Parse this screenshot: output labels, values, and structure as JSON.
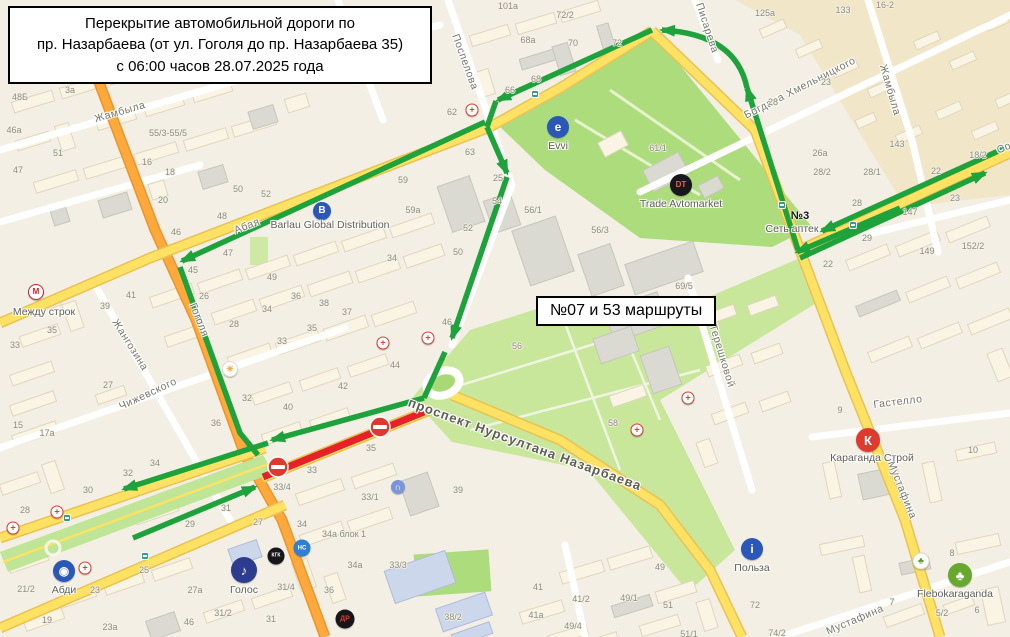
{
  "title_box": {
    "text": "Перекрытие автомобильной дороги по\nпр. Назарбаева (от ул. Гоголя до пр. Назарбаева 35)\nс 06:00 часов 28.07.2025 года"
  },
  "route_box": {
    "text": "№07 и 53 маршруты"
  },
  "colors": {
    "detour_green": "#1ea33c",
    "closed_red": "#e62129",
    "no_entry_red": "#e0372e",
    "road_yellow": "#ffe163",
    "road_orange": "#ffa93c",
    "park_green": "#addc7c",
    "background": "#f3efe4"
  },
  "map": {
    "street_labels": [
      {
        "text": "Жамбыла",
        "x": 120,
        "y": 112,
        "rot": -16
      },
      {
        "text": "Абая",
        "x": 247,
        "y": 226,
        "rot": -21
      },
      {
        "text": "Поспелова",
        "x": 465,
        "y": 62,
        "rot": 70
      },
      {
        "text": "Гоголя",
        "x": 199,
        "y": 320,
        "rot": 68
      },
      {
        "text": "Жангозина",
        "x": 130,
        "y": 345,
        "rot": 58
      },
      {
        "text": "Чижевского",
        "x": 148,
        "y": 394,
        "rot": -25
      },
      {
        "text": "Богдана Хмельницкого",
        "x": 800,
        "y": 88,
        "rot": -27
      },
      {
        "text": "Писарева",
        "x": 707,
        "y": 28,
        "rot": 72
      },
      {
        "text": "Жамбыла",
        "x": 890,
        "y": 90,
        "rot": 74
      },
      {
        "text": "Терешковой",
        "x": 722,
        "y": 356,
        "rot": 73
      },
      {
        "text": "Гастелло",
        "x": 898,
        "y": 402,
        "rot": -7
      },
      {
        "text": "Мустафина",
        "x": 902,
        "y": 490,
        "rot": 68
      },
      {
        "text": "Мустафина",
        "x": 855,
        "y": 620,
        "rot": -23
      },
      {
        "text": "Со",
        "x": 1004,
        "y": 148,
        "rot": -23
      },
      {
        "text": "проспект Нурсултана Назарбаева",
        "x": 525,
        "y": 444,
        "rot": 20,
        "avenue": true
      }
    ],
    "house_numbers": [
      {
        "t": "48Б",
        "x": 20,
        "y": 97
      },
      {
        "t": "46а",
        "x": 14,
        "y": 130
      },
      {
        "t": "3а",
        "x": 70,
        "y": 90
      },
      {
        "t": "51",
        "x": 58,
        "y": 153
      },
      {
        "t": "47",
        "x": 18,
        "y": 170
      },
      {
        "t": "55/3-55/5",
        "x": 168,
        "y": 133
      },
      {
        "t": "16",
        "x": 147,
        "y": 162
      },
      {
        "t": "18",
        "x": 170,
        "y": 172
      },
      {
        "t": "20",
        "x": 163,
        "y": 200
      },
      {
        "t": "50",
        "x": 238,
        "y": 189
      },
      {
        "t": "48",
        "x": 222,
        "y": 216
      },
      {
        "t": "52",
        "x": 266,
        "y": 194
      },
      {
        "t": "46",
        "x": 176,
        "y": 232
      },
      {
        "t": "47",
        "x": 228,
        "y": 253
      },
      {
        "t": "45",
        "x": 193,
        "y": 270
      },
      {
        "t": "49",
        "x": 272,
        "y": 277
      },
      {
        "t": "26",
        "x": 204,
        "y": 296
      },
      {
        "t": "34",
        "x": 267,
        "y": 309
      },
      {
        "t": "36",
        "x": 296,
        "y": 296
      },
      {
        "t": "38",
        "x": 324,
        "y": 303
      },
      {
        "t": "37",
        "x": 347,
        "y": 312
      },
      {
        "t": "35",
        "x": 312,
        "y": 328
      },
      {
        "t": "33",
        "x": 282,
        "y": 341
      },
      {
        "t": "28",
        "x": 234,
        "y": 324
      },
      {
        "t": "27",
        "x": 108,
        "y": 385
      },
      {
        "t": "42",
        "x": 343,
        "y": 386
      },
      {
        "t": "32",
        "x": 247,
        "y": 398
      },
      {
        "t": "40",
        "x": 288,
        "y": 407
      },
      {
        "t": "36",
        "x": 216,
        "y": 423
      },
      {
        "t": "41",
        "x": 131,
        "y": 295
      },
      {
        "t": "39",
        "x": 105,
        "y": 306
      },
      {
        "t": "59а",
        "x": 413,
        "y": 210
      },
      {
        "t": "63",
        "x": 470,
        "y": 152
      },
      {
        "t": "59",
        "x": 403,
        "y": 180
      },
      {
        "t": "25",
        "x": 498,
        "y": 178
      },
      {
        "t": "54",
        "x": 497,
        "y": 201
      },
      {
        "t": "52",
        "x": 468,
        "y": 228
      },
      {
        "t": "50",
        "x": 458,
        "y": 252
      },
      {
        "t": "56/1",
        "x": 533,
        "y": 210
      },
      {
        "t": "34",
        "x": 392,
        "y": 258
      },
      {
        "t": "101а",
        "x": 508,
        "y": 6
      },
      {
        "t": "72/2",
        "x": 565,
        "y": 15
      },
      {
        "t": "68а",
        "x": 528,
        "y": 40
      },
      {
        "t": "70",
        "x": 573,
        "y": 43
      },
      {
        "t": "72",
        "x": 617,
        "y": 43
      },
      {
        "t": "68",
        "x": 536,
        "y": 79
      },
      {
        "t": "66",
        "x": 510,
        "y": 90
      },
      {
        "t": "62",
        "x": 452,
        "y": 112
      },
      {
        "t": "125а",
        "x": 765,
        "y": 13
      },
      {
        "t": "133",
        "x": 843,
        "y": 10
      },
      {
        "t": "16-2",
        "x": 885,
        "y": 5
      },
      {
        "t": "23",
        "x": 826,
        "y": 82
      },
      {
        "t": "28",
        "x": 773,
        "y": 102
      },
      {
        "t": "26а",
        "x": 820,
        "y": 153
      },
      {
        "t": "143",
        "x": 897,
        "y": 144
      },
      {
        "t": "28/2",
        "x": 822,
        "y": 172
      },
      {
        "t": "28/1",
        "x": 872,
        "y": 172
      },
      {
        "t": "22",
        "x": 936,
        "y": 171
      },
      {
        "t": "18/2",
        "x": 978,
        "y": 155
      },
      {
        "t": "23",
        "x": 955,
        "y": 198
      },
      {
        "t": "28",
        "x": 857,
        "y": 203
      },
      {
        "t": "147",
        "x": 910,
        "y": 212
      },
      {
        "t": "29",
        "x": 867,
        "y": 238
      },
      {
        "t": "149",
        "x": 927,
        "y": 251
      },
      {
        "t": "152/2",
        "x": 973,
        "y": 246
      },
      {
        "t": "22",
        "x": 828,
        "y": 264
      },
      {
        "t": "9",
        "x": 840,
        "y": 410
      },
      {
        "t": "10",
        "x": 973,
        "y": 450
      },
      {
        "t": "72",
        "x": 755,
        "y": 605
      },
      {
        "t": "74/2",
        "x": 777,
        "y": 633
      },
      {
        "t": "7",
        "x": 892,
        "y": 602
      },
      {
        "t": "8",
        "x": 952,
        "y": 553
      },
      {
        "t": "6",
        "x": 977,
        "y": 610
      },
      {
        "t": "5/2",
        "x": 942,
        "y": 613
      },
      {
        "t": "29",
        "x": 190,
        "y": 524
      },
      {
        "t": "27",
        "x": 258,
        "y": 522
      },
      {
        "t": "34",
        "x": 302,
        "y": 524
      },
      {
        "t": "25",
        "x": 144,
        "y": 570
      },
      {
        "t": "27а",
        "x": 195,
        "y": 590
      },
      {
        "t": "21/2",
        "x": 26,
        "y": 589
      },
      {
        "t": "23",
        "x": 95,
        "y": 590
      },
      {
        "t": "19",
        "x": 47,
        "y": 620
      },
      {
        "t": "23а",
        "x": 110,
        "y": 627
      },
      {
        "t": "46",
        "x": 189,
        "y": 622
      },
      {
        "t": "31/2",
        "x": 223,
        "y": 613
      },
      {
        "t": "31",
        "x": 271,
        "y": 619
      },
      {
        "t": "31/4",
        "x": 286,
        "y": 587
      },
      {
        "t": "34а блок 1",
        "x": 344,
        "y": 534
      },
      {
        "t": "34а",
        "x": 355,
        "y": 565
      },
      {
        "t": "36",
        "x": 329,
        "y": 590
      },
      {
        "t": "33/3",
        "x": 398,
        "y": 565
      },
      {
        "t": "38/2",
        "x": 453,
        "y": 617
      },
      {
        "t": "41",
        "x": 538,
        "y": 587
      },
      {
        "t": "41/2",
        "x": 581,
        "y": 599
      },
      {
        "t": "41а",
        "x": 536,
        "y": 615
      },
      {
        "t": "49/4",
        "x": 573,
        "y": 626
      },
      {
        "t": "49/1",
        "x": 629,
        "y": 598
      },
      {
        "t": "49",
        "x": 660,
        "y": 567
      },
      {
        "t": "51",
        "x": 668,
        "y": 605
      },
      {
        "t": "51/1",
        "x": 689,
        "y": 634
      },
      {
        "t": "35",
        "x": 371,
        "y": 448
      },
      {
        "t": "33",
        "x": 312,
        "y": 470
      },
      {
        "t": "33/4",
        "x": 282,
        "y": 487
      },
      {
        "t": "33/1",
        "x": 370,
        "y": 497
      },
      {
        "t": "39",
        "x": 458,
        "y": 490
      },
      {
        "t": "58",
        "x": 613,
        "y": 423
      },
      {
        "t": "56",
        "x": 517,
        "y": 346
      },
      {
        "t": "44",
        "x": 395,
        "y": 365
      },
      {
        "t": "46",
        "x": 447,
        "y": 322
      },
      {
        "t": "33",
        "x": 15,
        "y": 345
      },
      {
        "t": "35",
        "x": 52,
        "y": 330
      },
      {
        "t": "15",
        "x": 18,
        "y": 425
      },
      {
        "t": "17а",
        "x": 47,
        "y": 433
      },
      {
        "t": "34",
        "x": 155,
        "y": 463
      },
      {
        "t": "32",
        "x": 128,
        "y": 473
      },
      {
        "t": "30",
        "x": 88,
        "y": 490
      },
      {
        "t": "28",
        "x": 25,
        "y": 510
      },
      {
        "t": "31",
        "x": 226,
        "y": 508
      },
      {
        "t": "69/5",
        "x": 684,
        "y": 286
      },
      {
        "t": "56/3",
        "x": 600,
        "y": 230
      },
      {
        "t": "61/1",
        "x": 658,
        "y": 148
      }
    ],
    "pois": [
      {
        "id": "evvi",
        "glyph": "e",
        "bg": "#2b58b8",
        "fg": "#fff",
        "x": 558,
        "y": 127,
        "d": 22,
        "label": "Evvi",
        "lx": 558,
        "ly": 140
      },
      {
        "id": "trade-avtomarket",
        "glyph": "DT",
        "bg": "#18181c",
        "fg": "#ff5a36",
        "x": 681,
        "y": 185,
        "d": 22,
        "gs": 8,
        "label": "Trade Avtomarket",
        "lx": 681,
        "ly": 198
      },
      {
        "id": "barlau",
        "glyph": "В",
        "bg": "#2b58b8",
        "fg": "#fff",
        "x": 322,
        "y": 211,
        "d": 18,
        "label": "Barlau Global Distribution",
        "lx": 330,
        "ly": 219
      },
      {
        "id": "mezhdu-strok",
        "glyph": "М",
        "bg": "#ffffff",
        "fg": "#d21f26",
        "x": 36,
        "y": 292,
        "d": 14,
        "border": "#d21f26",
        "label": "Между строк",
        "lx": 44,
        "ly": 306
      },
      {
        "id": "karaganda-stroy",
        "glyph": "К",
        "bg": "#e0392e",
        "fg": "#fff",
        "x": 868,
        "y": 440,
        "d": 24,
        "label": "Караганда Строй",
        "lx": 872,
        "ly": 452
      },
      {
        "id": "polza",
        "glyph": "i",
        "bg": "#2b58b8",
        "fg": "#fff",
        "x": 752,
        "y": 549,
        "d": 22,
        "label": "Польза",
        "lx": 752,
        "ly": 562
      },
      {
        "id": "flebokaraganda",
        "glyph": "♣",
        "bg": "#69a82f",
        "fg": "#fff",
        "x": 960,
        "y": 575,
        "d": 24,
        "label": "Flebokaraganda",
        "lx": 955,
        "ly": 588
      },
      {
        "id": "abdi",
        "glyph": "◉",
        "bg": "#2b58b8",
        "fg": "#fff",
        "x": 64,
        "y": 571,
        "d": 22,
        "label": "Абди",
        "lx": 64,
        "ly": 584
      },
      {
        "id": "golos",
        "glyph": "♪",
        "bg": "#2d3c8e",
        "fg": "#fff",
        "x": 244,
        "y": 570,
        "d": 26,
        "gs": 13,
        "label": "Голос",
        "lx": 244,
        "ly": 584
      },
      {
        "id": "kgk",
        "glyph": "КГК",
        "bg": "#17171a",
        "fg": "#fff",
        "x": 276,
        "y": 556,
        "d": 17,
        "gs": 5
      },
      {
        "id": "ns",
        "glyph": "НС",
        "bg": "#2f80d0",
        "fg": "#fff",
        "x": 302,
        "y": 548,
        "d": 17,
        "gs": 6
      },
      {
        "id": "dom-rida",
        "glyph": "ДР",
        "bg": "#17171a",
        "fg": "#e0392e",
        "x": 345,
        "y": 619,
        "d": 19,
        "gs": 7
      },
      {
        "id": "university",
        "glyph": "∩",
        "bg": "#7a95d8",
        "fg": "#fff",
        "x": 398,
        "y": 487,
        "d": 14,
        "gs": 9
      },
      {
        "id": "sunrise",
        "glyph": "☀",
        "bg": "#fff",
        "fg": "#f5a43a",
        "x": 230,
        "y": 369,
        "d": 14,
        "gs": 9,
        "border": "#e4dcc8"
      },
      {
        "id": "leaf",
        "glyph": "♣",
        "bg": "#fff",
        "fg": "#5a9e2f",
        "x": 921,
        "y": 561,
        "d": 15,
        "gs": 9,
        "border": "#d8d8d0"
      },
      {
        "id": "set-aptek",
        "text_only": true,
        "glyph": "№3",
        "x": 800,
        "y": 216,
        "label": "Сеть аптек",
        "lx": 792,
        "ly": 223
      }
    ],
    "medical_crosses": [
      {
        "x": 472,
        "y": 110
      },
      {
        "x": 383,
        "y": 343
      },
      {
        "x": 428,
        "y": 338
      },
      {
        "x": 57,
        "y": 512
      },
      {
        "x": 13,
        "y": 528
      },
      {
        "x": 85,
        "y": 568
      },
      {
        "x": 637,
        "y": 430
      },
      {
        "x": 688,
        "y": 398
      }
    ],
    "transit_stops": [
      {
        "x": 535,
        "y": 94
      },
      {
        "x": 782,
        "y": 205
      },
      {
        "x": 853,
        "y": 225
      },
      {
        "x": 145,
        "y": 556
      },
      {
        "x": 67,
        "y": 518
      }
    ]
  }
}
